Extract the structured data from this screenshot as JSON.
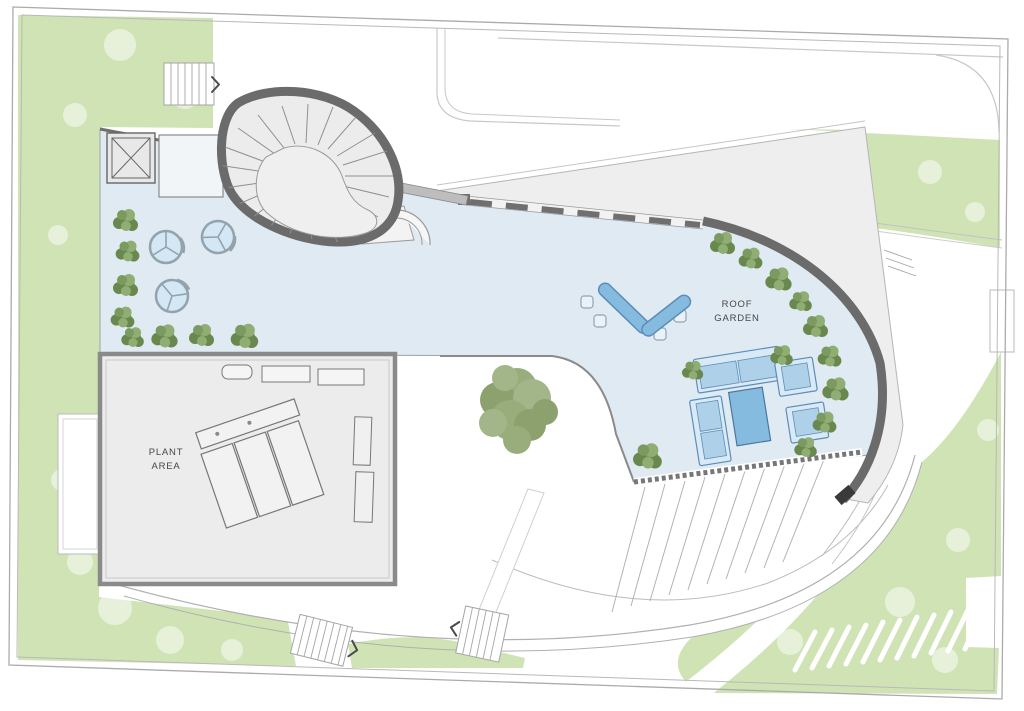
{
  "labels": {
    "roof_garden_line1": "ROOF",
    "roof_garden_line2": "GARDEN",
    "plant_area_line1": "PLANT",
    "plant_area_line2": "AREA"
  },
  "colors": {
    "deck_blue": "#dfeaf3",
    "plant_gray": "#ececec",
    "wedge_gray": "#eeeeee",
    "lawn_green": "#cfe3b5",
    "tree_green": "#7a9a5f",
    "tree_green_dark": "#69884e",
    "tree_green_light": "#90ad74",
    "big_tree_green": "#93a876",
    "band_gray": "#6b6b6b",
    "wall_gray": "#8a8a8a",
    "line_gray": "#b0b0b0",
    "furn_fill": "#d9eaf6",
    "furn_seat": "#aed0e9",
    "furn_accent": "#85bbdf",
    "furn_stroke": "#5b8db8",
    "umbrella_fill": "#d3e7f4",
    "umbrella_stroke": "#93a3ad",
    "text_gray": "#474747"
  }
}
